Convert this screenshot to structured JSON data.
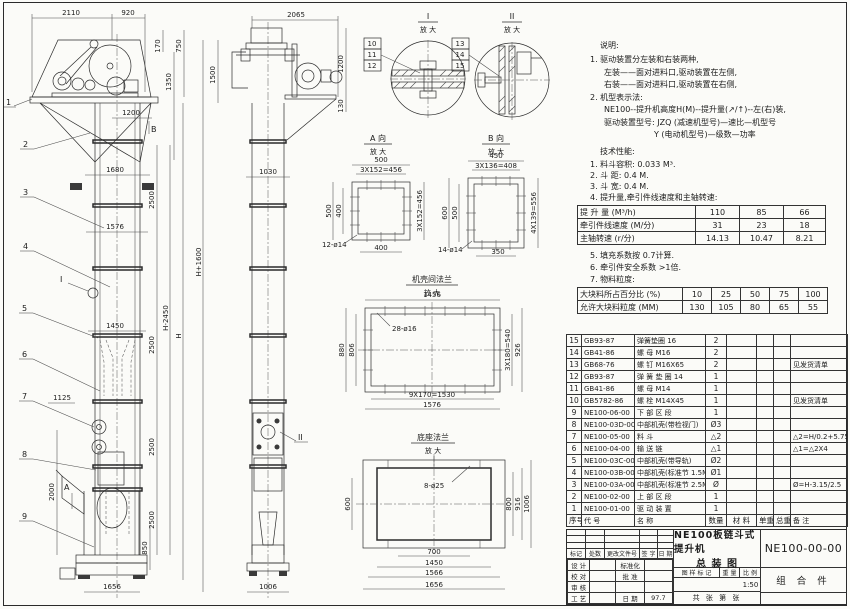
{
  "notes": {
    "title": "说明:",
    "lines": [
      "1. 驱动装置分左装和右装两种,",
      "左装——面对进料口,驱动装置在左侧,",
      "右装——面对进料口,驱动装置在右侧,",
      "2. 机型表示法:",
      "NE100--提升机高度H(M)--提升量(↗/↑)--左(右)装,",
      "驱动装置型号: JZQ (减速机型号)—速比—机型号",
      "Y (电动机型号)—级数—功率"
    ]
  },
  "tech": {
    "title": "技术性能:",
    "lines": [
      "1. 料斗容积: 0.033 M³.",
      "2. 斗  距: 0.4 M.",
      "3. 斗  宽: 0.4 M.",
      "4. 提升量,牵引件线速度和主轴转速:"
    ],
    "lines2": [
      "5. 填充系数按 0.7计算.",
      "6. 牵引件安全系数 >1倍.",
      "7. 物料粒度:"
    ]
  },
  "capacity_table": {
    "rows": [
      [
        "提 升 量  (M³/h)",
        "110",
        "85",
        "66"
      ],
      [
        "牵引件线速度 (M/分)",
        "31",
        "23",
        "18"
      ],
      [
        "主轴转速  (r/分)",
        "14.13",
        "10.47",
        "8.21"
      ]
    ]
  },
  "size_table": {
    "rows": [
      [
        "大块料所占百分比 (%)",
        "10",
        "25",
        "50",
        "75",
        "100"
      ],
      [
        "允许大块料粒度 (MM)",
        "130",
        "105",
        "80",
        "65",
        "55"
      ]
    ]
  },
  "bom": {
    "rows": [
      [
        "15",
        "GB93-87",
        "弹簧垫圈  16",
        "2",
        "",
        "",
        "",
        ""
      ],
      [
        "14",
        "GB41-86",
        "螺 母  M16",
        "2",
        "",
        "",
        "",
        ""
      ],
      [
        "13",
        "GB68-76",
        "螺 钉  M16X65",
        "2",
        "",
        "",
        "",
        "见发货清单"
      ],
      [
        "12",
        "GB93-87",
        "弹 簧 垫 圈  14",
        "1",
        "",
        "",
        "",
        ""
      ],
      [
        "11",
        "GB41-86",
        "螺 母  M14",
        "1",
        "",
        "",
        "",
        ""
      ],
      [
        "10",
        "GB5782-86",
        "螺 栓  M14X45",
        "1",
        "",
        "",
        "",
        "见发货清单"
      ],
      [
        "9",
        "NE100-06-00",
        "下 部 区 段",
        "1",
        "",
        "",
        "",
        ""
      ],
      [
        "8",
        "NE100-03D-00",
        "中部机壳(带检视门)",
        "Ø3",
        "",
        "",
        "",
        ""
      ],
      [
        "7",
        "NE100-05-00",
        "料 斗",
        "△2",
        "",
        "",
        "",
        "△2=H/0.2+5.75"
      ],
      [
        "6",
        "NE100-04-00",
        "输 送 链",
        "△1",
        "",
        "",
        "",
        "△1=△2X4"
      ],
      [
        "5",
        "NE100-03C-00",
        "中部机壳(带导轨)",
        "Ø2",
        "",
        "",
        "",
        ""
      ],
      [
        "4",
        "NE100-03B-00",
        "中部机壳(标准节 1.5M,1M)",
        "Ø1",
        "",
        "",
        "",
        ""
      ],
      [
        "3",
        "NE100-03A-00",
        "中部机壳(标准节 2.5M)",
        "Ø",
        "",
        "",
        "",
        "Ø=H-3.15/2.5"
      ],
      [
        "2",
        "NE100-02-00",
        "上 部 区 段",
        "1",
        "",
        "",
        "",
        ""
      ],
      [
        "1",
        "NE100-01-00",
        "驱 动 装 置",
        "1",
        "",
        "",
        "",
        ""
      ]
    ],
    "header_rows": [
      [
        "序号",
        "代  号",
        "名    称",
        "数量",
        "材  料",
        "单重",
        "总重",
        "备  注"
      ]
    ]
  },
  "title_block": {
    "rev_cols": [
      "标记",
      "处数",
      "更改文件号",
      "签 字",
      "日 期"
    ],
    "roles": [
      [
        "设 计",
        "",
        "标准化",
        ""
      ],
      [
        "校 对",
        "",
        "批 准",
        ""
      ],
      [
        "审 核",
        "",
        "",
        ""
      ],
      [
        "工 艺",
        "",
        "日 期",
        "97.7"
      ]
    ],
    "title1": "NE100板链斗式提升机",
    "title2": "总  装  图",
    "mark_label": "图 样 标 记",
    "weight_label": "重 量",
    "scale_label": "比 例",
    "scale": "1:50",
    "sheets": "共  张  第  张",
    "drawing_no": "NE100-00-00",
    "assembly": "组 合 件"
  },
  "front_view": {
    "dims": {
      "head_width": "2110",
      "head_offset": "920",
      "d170": "170",
      "d750": "750",
      "d1350": "1350",
      "d1500": "1500",
      "col_width": "1200",
      "flange1": "1680",
      "flange2": "1576",
      "section": "2500",
      "mid_width": "1450",
      "h_mid": "H-2450",
      "h": "H",
      "h_overall": "H+1600",
      "feed_width": "1125",
      "feed_height": "2000",
      "base_height": "850",
      "base_width": "1656"
    },
    "callouts": [
      "1",
      "2",
      "3",
      "4",
      "5",
      "6",
      "7",
      "8",
      "9"
    ],
    "view_marks": {
      "a": "A",
      "b": "B",
      "detail_i": "I"
    }
  },
  "side_view": {
    "dims": {
      "head_width": "2065",
      "d1200": "1200",
      "d130": "130",
      "col_width": "1030",
      "base_width": "1006"
    },
    "detail_mark": "II"
  },
  "details": {
    "d1": {
      "label": "I",
      "sub": "放 大",
      "callouts": [
        "10",
        "11",
        "12"
      ]
    },
    "d2": {
      "label": "II",
      "sub": "放 大",
      "callouts": [
        "13",
        "14",
        "15"
      ]
    },
    "va": {
      "label": "A 向",
      "sub": "放 大",
      "dims": {
        "top": "500",
        "top2": "3X152=456",
        "left": "500",
        "left2": "400",
        "right": "3X152=456",
        "bottom": "400",
        "holes": "12-ø14"
      }
    },
    "vb": {
      "label": "B 向",
      "sub": "放 大",
      "dims": {
        "top": "450",
        "top2": "3X136=408",
        "left": "600",
        "left2": "500",
        "right": "4X139=556",
        "bottom": "350",
        "holes": "14-ø14"
      }
    },
    "flange": {
      "label": "机壳间法兰",
      "sub": "放 大",
      "dims": {
        "top": "1456",
        "holes": "28-ø16",
        "left": "880",
        "left2": "806",
        "right": "3X180=540",
        "right2": "926",
        "bottom": "9X170=1530",
        "bottom2": "1576"
      }
    },
    "base": {
      "label": "底座法兰",
      "sub": "放 大",
      "dims": {
        "holes": "8-ø25",
        "left": "600",
        "right": "800",
        "right2": "916",
        "right3": "1006",
        "bottom": "700",
        "bottom2": "1450",
        "bottom3": "1566",
        "bottom4": "1656"
      }
    }
  }
}
